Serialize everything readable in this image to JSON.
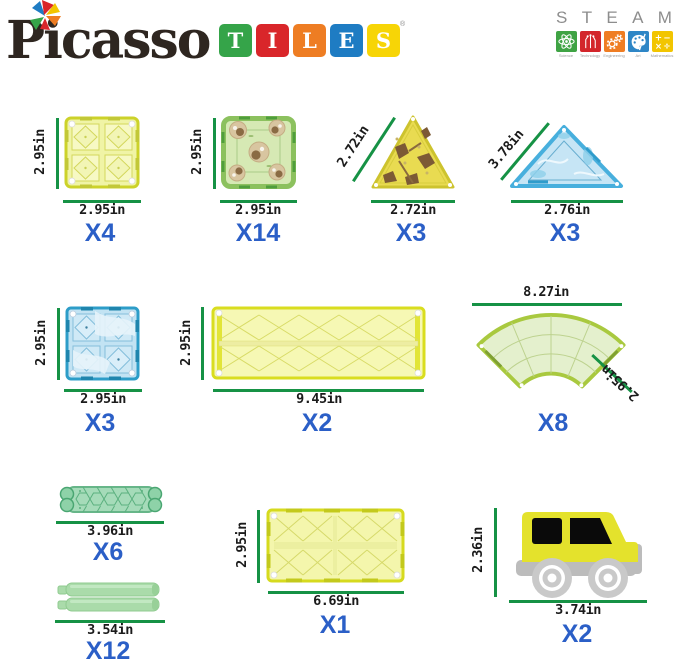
{
  "brand": {
    "name": "Picasso",
    "registered": "®",
    "tiles_letters": [
      {
        "ch": "T",
        "color": "#35a449"
      },
      {
        "ch": "I",
        "color": "#d9262a"
      },
      {
        "ch": "L",
        "color": "#ee7d23"
      },
      {
        "ch": "E",
        "color": "#1e7cc3"
      },
      {
        "ch": "S",
        "color": "#f7d506"
      }
    ]
  },
  "steam": {
    "letters": [
      "S",
      "T",
      "E",
      "A",
      "M"
    ],
    "fields": [
      {
        "label": "Science",
        "color": "#3fa344",
        "icon": "atom-icon"
      },
      {
        "label": "Technology",
        "color": "#d3262b",
        "icon": "circuit-icon"
      },
      {
        "label": "Engineering",
        "color": "#ef7d23",
        "icon": "gears-icon"
      },
      {
        "label": "Art",
        "color": "#2e86c6",
        "icon": "palette-icon"
      },
      {
        "label": "Mathematics",
        "color": "#f2c500",
        "icon": "math-icon"
      }
    ]
  },
  "colors": {
    "dimension_line": "#169245",
    "dimension_text": "#1b1b1b",
    "count_text": "#2b5fc7"
  },
  "items": [
    {
      "name": "yellow-square-tile",
      "height_label": "2.95in",
      "width_label": "2.95in",
      "count": "X4"
    },
    {
      "name": "green-pattern-square-tile",
      "height_label": "2.95in",
      "width_label": "2.95in",
      "count": "X14"
    },
    {
      "name": "camo-triangle-tile",
      "slant_label": "2.72in",
      "width_label": "2.72in",
      "count": "X3"
    },
    {
      "name": "blue-triangle-tile",
      "slant_label": "3.78in",
      "width_label": "2.76in",
      "count": "X3"
    },
    {
      "name": "blue-square-tile",
      "height_label": "2.95in",
      "width_label": "2.95in",
      "count": "X3"
    },
    {
      "name": "long-rectangle-tile",
      "height_label": "2.95in",
      "width_label": "9.45in",
      "count": "X2"
    },
    {
      "name": "curved-road-tile",
      "top_label": "8.27in",
      "side_label": "2.95in",
      "count": "X8"
    },
    {
      "name": "guardrail-piece",
      "width_label": "3.96in",
      "count": "X6"
    },
    {
      "name": "straight-rail-pieces",
      "width_label": "3.54in",
      "count": "X12"
    },
    {
      "name": "rectangle-tile",
      "height_label": "2.95in",
      "width_label": "6.69in",
      "count": "X1"
    },
    {
      "name": "car-vehicle",
      "height_label": "2.36in",
      "width_label": "3.74in",
      "count": "X2"
    }
  ]
}
